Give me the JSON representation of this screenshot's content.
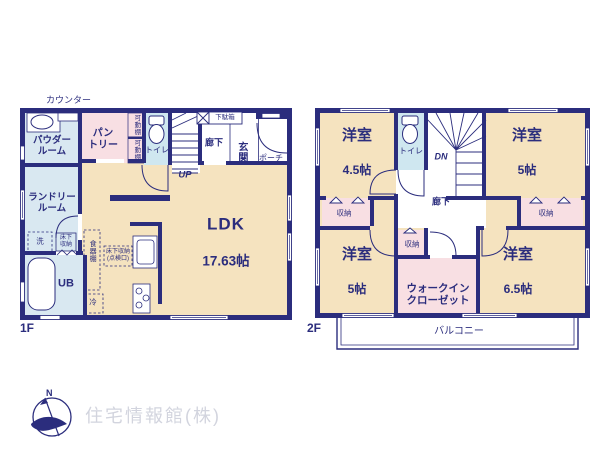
{
  "meta": {
    "document_type": "floor-plan",
    "floors": [
      "1F",
      "2F"
    ]
  },
  "colors": {
    "wall_navy": "#2b2d7d",
    "room_cream": "#f5e3bf",
    "room_pink": "#f8dfe3",
    "room_blue": "#d9e8f1",
    "toilet_blue": "#cfe7f0",
    "logo_gray": "#d2d4de"
  },
  "floor1": {
    "label": "1F",
    "counter": "カウンター",
    "powder_room": "パウダー\nルーム",
    "laundry_room": "ランドリー\nルーム",
    "unit_bath": "UB",
    "pantry": "パン\nトリー",
    "shelf_upper": "可動棚",
    "shelf_lower": "可動棚",
    "toilet": "トイレ",
    "stairs_up": "UP",
    "hallway": "廊下",
    "entrance": "玄関",
    "shoe_cabinet": "下駄箱",
    "porch": "ポーチ",
    "ldk_name": "LDK",
    "ldk_size": "17.63帖",
    "washer": "洗",
    "underfloor_storage": "床下\n収納",
    "cupboard": "食器棚",
    "underfloor_inspection": "床下収納\n(点検口)",
    "fridge": "冷"
  },
  "floor2": {
    "label": "2F",
    "room_nw_name": "洋室",
    "room_nw_size": "4.5帖",
    "room_ne_name": "洋室",
    "room_ne_size": "5帖",
    "room_sw_name": "洋室",
    "room_sw_size": "5帖",
    "room_se_name": "洋室",
    "room_se_size": "6.5帖",
    "toilet": "トイレ",
    "stairs_down": "DN",
    "hallway": "廊下",
    "closet_nw": "収納",
    "closet_ne": "収納",
    "closet_center": "収納",
    "walk_in_closet": "ウォークイン\nクローゼット",
    "balcony": "バルコニー"
  },
  "footer": {
    "north_mark": "N",
    "company": "住宅情報館(株)"
  }
}
